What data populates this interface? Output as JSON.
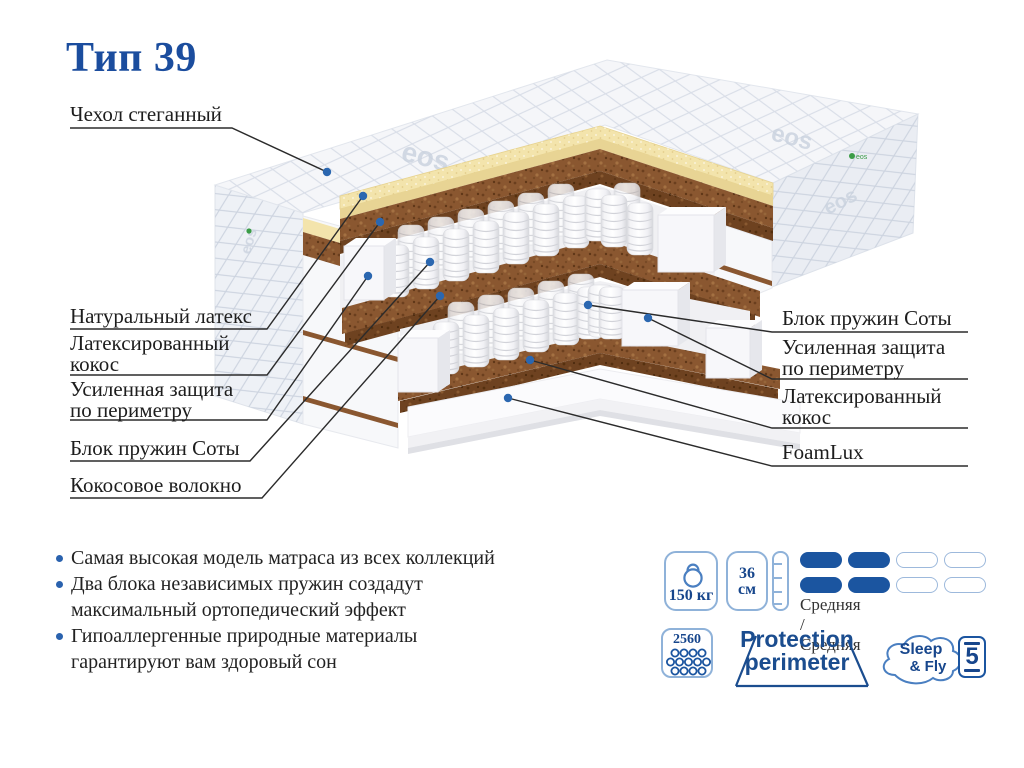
{
  "title": "Тип 39",
  "watermark": "eos",
  "callouts": {
    "left": [
      {
        "label": "Чехол стеганный"
      },
      {
        "label": "Натуральный латекс"
      },
      {
        "label": "Латексированный кокос"
      },
      {
        "label": "Усиленная защита по периметру"
      },
      {
        "label": "Блок пружин Соты"
      },
      {
        "label": "Кокосовое волокно"
      }
    ],
    "right": [
      {
        "label": "Блок пружин Соты"
      },
      {
        "label": "Усиленная защита по периметру"
      },
      {
        "label": "Латексированный кокос"
      },
      {
        "label": "FoamLux"
      }
    ]
  },
  "features": [
    "Самая высокая модель матраса из всех коллекций",
    "Два блока независимых пружин создадут максимальный ортопедический эффект",
    "Гипоаллергенные природные материалы гарантируют вам здоровый сон"
  ],
  "specs": {
    "max_load": "150 кг",
    "height_value": "36",
    "height_unit": "см",
    "firmness_label": "Средняя / Средняя",
    "firmness_filled": 2,
    "firmness_total": 4,
    "springs_count": "2560",
    "protection_line1": "Protection",
    "protection_line2": "perimeter",
    "brand_line1": "Sleep",
    "brand_line2": "& Fly",
    "warranty_years": "5"
  },
  "colors": {
    "brand_blue": "#1b4d9e",
    "icon_blue": "#17468c",
    "icon_outline": "#8fb2d9",
    "firmness_fill": "#1b55a0",
    "latex_yellow": "#f3e4ac",
    "coir_brown": "#8a5730",
    "eco_green": "#3a9c46",
    "callout_dot": "#2b67b0"
  }
}
